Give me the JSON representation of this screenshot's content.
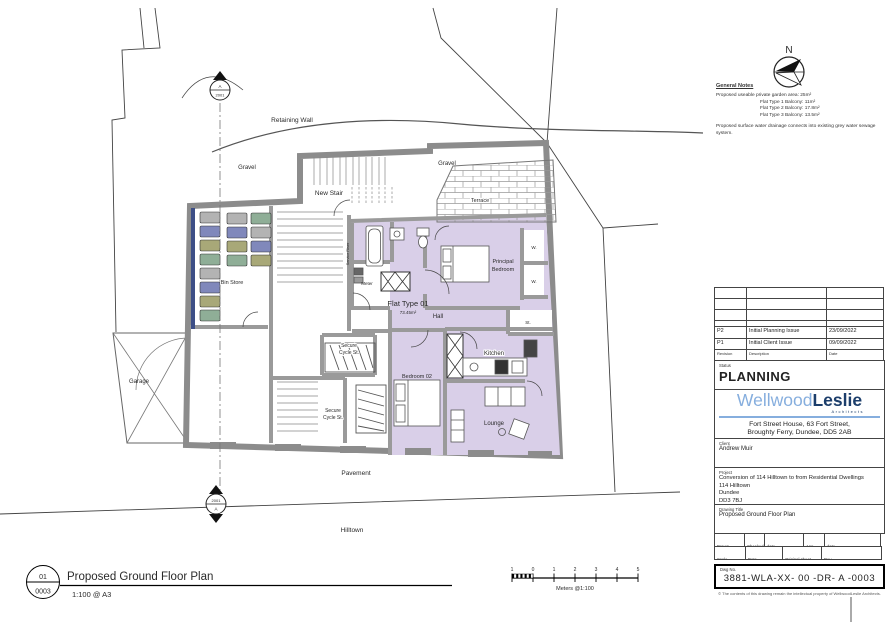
{
  "colors": {
    "flat_fill": "#d9cfe8",
    "wall_gray": "#9a9a9a",
    "logo_light_blue": "#86aede",
    "logo_dark_blue": "#1c3e6b",
    "bin_gray": "#b3b3b3",
    "bin_blue": "#8088bb",
    "bin_olive": "#a8a878",
    "bin_teal": "#8fae97"
  },
  "north": {
    "label": "N"
  },
  "general_notes": {
    "title": "General Notes",
    "line1": "Proposed useable private garden area: 25m²",
    "line2": "Flat Type 1 Balcony: 11m²",
    "line3": "Flat Type 2 Balcony: 17.8m²",
    "line4": "Flat Type 3 Balcony: 13.5m²",
    "para": "Proposed surface water drainage connects into existing grey water sewage system."
  },
  "plan": {
    "labels": {
      "retaining_wall": "Retaining Wall",
      "gravel_left": "Gravel",
      "gravel_right": "Gravel",
      "new_stair": "New Stair",
      "terrace": "Terrace",
      "bin_store": "Bin Store",
      "garage": "Garage",
      "meter": "Meter",
      "flat_type": "Flat Type 01",
      "flat_area": "73.45m²",
      "hall": "Hall",
      "principal_line1": "Principal",
      "principal_line2": "Bedroom",
      "wardrobe_top": "W.",
      "wardrobe_bottom": "W.",
      "store": "St.",
      "kitchen": "Kitchen",
      "bedroom_02": "Bedroom 02",
      "lounge": "Lounge",
      "secure_top_line1": "Secure",
      "secure_top_line2": "Cycle St.",
      "secure_bottom_line1": "Secure",
      "secure_bottom_line2": "Cycle St.",
      "service_riser": "Service Riser",
      "pavement": "Pavement",
      "hilltown": "Hilltown"
    },
    "section_marker_top": {
      "top": "A",
      "bottom": "2001"
    },
    "section_marker_bottom": {
      "top": "2001",
      "bottom": "A"
    }
  },
  "scale_bar": {
    "ticks": [
      "1",
      "0",
      "1",
      "2",
      "3",
      "4",
      "5"
    ],
    "label": "Meters @1:100"
  },
  "footer": {
    "detail_number": "01",
    "sheet_number": "0003",
    "title": "Proposed Ground Floor Plan",
    "scale_note": "1:100 @ A3"
  },
  "title_block": {
    "revision_header": {
      "revision": "Revision",
      "description": "Description",
      "date": "Date"
    },
    "revisions": [
      {
        "rev": "P2",
        "description": "Initial Planning Issue",
        "date": "23/09/2022"
      },
      {
        "rev": "P1",
        "description": "Initial Client Issue",
        "date": "09/09/2022"
      }
    ],
    "status_label": "Status",
    "status": "PLANNING",
    "logo": {
      "word1": "Wellwood",
      "word2": "Leslie",
      "tagline": "Architects"
    },
    "address_line1": "Fort Street House, 63 Fort Street,",
    "address_line2": "Broughty Ferry, Dundee, DD5 2AB",
    "contact": "t: 01382 778829   e: admin@wellwoodleslie.com",
    "client_label": "Client",
    "client": "Andrew Muir",
    "project_label": "Project",
    "project_line1": "Conversion of 114 Hilltown to from Residential Dwellings",
    "project_line2": "114 Hilltown",
    "project_line3": "Dundee",
    "project_line4": "DD3 7BJ",
    "drawing_title_label": "Drawing Title",
    "drawing_title": "Proposed Ground Floor Plan",
    "meta": {
      "drawn_label": "Drawn",
      "drawn": "RIH",
      "checked_label": "Checked",
      "checked": "S.McP",
      "date1_label": "date",
      "date1": "Sept 22'",
      "app_label": "App",
      "app": "S.McP",
      "date2_label": "date",
      "date2": "Sept 22'",
      "scale_label": "Scale",
      "scale": "1:100",
      "date3_label": "Date",
      "date3": "Sept 22'",
      "sheet_label": "Original sheet size",
      "sheet": "A3",
      "rev_label": "Rev",
      "rev": "P2"
    },
    "dwg_label": "Dwg No.",
    "dwg_no": "3881-WLA-XX- 00 -DR- A -0003",
    "copyright": "© The contents of this drawing remain the intellectual property of WellwoodLeslie Architects."
  }
}
